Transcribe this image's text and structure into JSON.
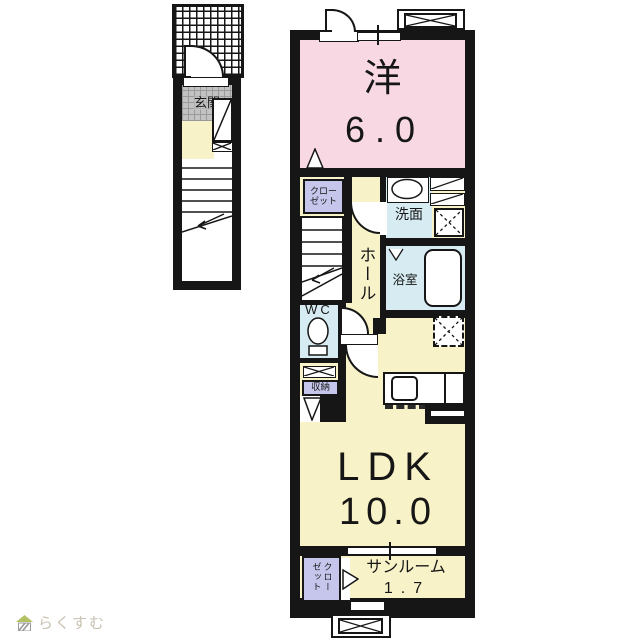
{
  "title": "apartment-floorplan",
  "rooms": {
    "western": {
      "label": "洋",
      "size": "6.0"
    },
    "ldk": {
      "label": "LDK",
      "size": "10.0"
    },
    "sunroom": {
      "label": "サンルーム",
      "size": "1.7"
    },
    "hall": {
      "label": "ホール"
    },
    "washroom": {
      "label": "洗面"
    },
    "bathroom": {
      "label": "浴室"
    },
    "wc": {
      "label": "WC"
    },
    "storage": {
      "label": "収納"
    },
    "closet": {
      "line1": "クロー",
      "line2": "ゼット"
    },
    "sunroom_closet": {
      "label": "クローゼット"
    },
    "entrance": {
      "label": "玄関"
    }
  },
  "logo": {
    "text": "らくすむ"
  },
  "icons": {
    "stairs-icon": "stepped lines with down arrow",
    "toilet-icon": "oval bowl with tank",
    "bathtub-icon": "rounded rectangle tub",
    "sink-icon": "oval basin",
    "kitchen-sink-icon": "rounded square in counter",
    "washer-place-icon": "square with dashed X",
    "fridge-place-icon": "dashed square with dashed X",
    "meter-box-icon": "rectangle with X",
    "door-arc-icon": "quarter-circle swing",
    "window-icon": "white strip in wall",
    "house-logo-icon": "small house with green roof"
  },
  "colors": {
    "wall": "#161616",
    "pink": "#f8d8e3",
    "yellow": "#f8f2c8",
    "lavender": "#c6c6ec",
    "blue": "#d7ecf2",
    "gray": "#c2c2c2",
    "logotext": "#c9c1b2",
    "logogreen": "#b4c162"
  }
}
